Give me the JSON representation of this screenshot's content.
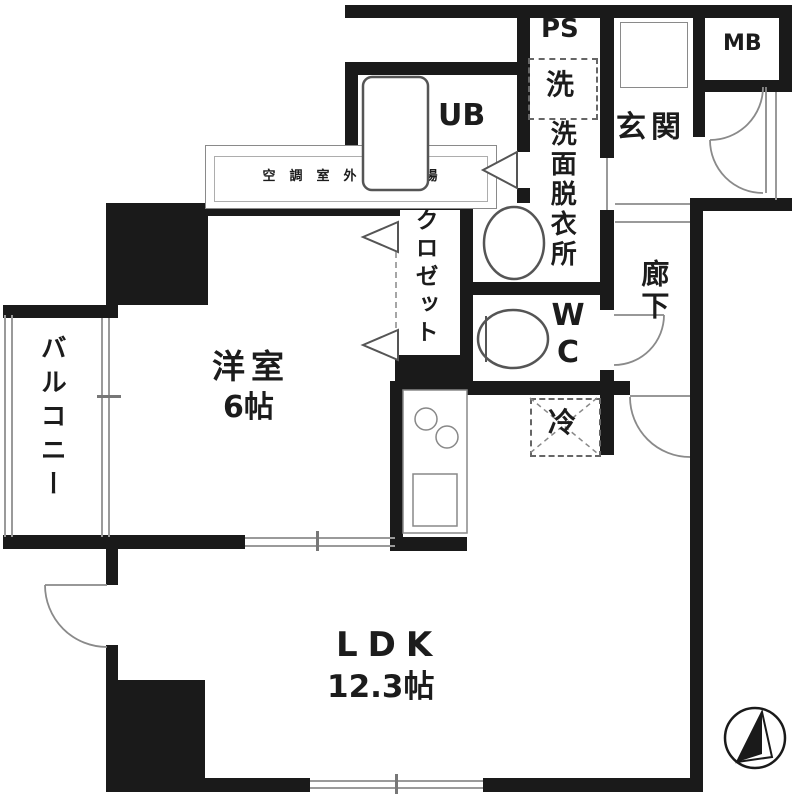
{
  "plan_type": "apartment-floor-plan",
  "colors": {
    "wall": "#1a1a1a",
    "background": "#ffffff",
    "thin_line": "#9a9a9a"
  },
  "rooms": {
    "balcony": "バルコニー",
    "western_room": "洋室",
    "western_room_size": "6帖",
    "ldk": "LDK",
    "ldk_size": "12.3帖",
    "unit_bath": "UB",
    "pipe_space": "PS",
    "washer": "洗",
    "washroom": "洗面脱衣所",
    "wc": "WC",
    "closet": "クロゼット",
    "entrance": "玄関",
    "hallway": "廊下",
    "meter_box": "MB",
    "refrigerator": "冷",
    "ac_outdoor_unit": "空調室外機置場"
  },
  "icons": {
    "compass": "north-arrow-icon"
  }
}
